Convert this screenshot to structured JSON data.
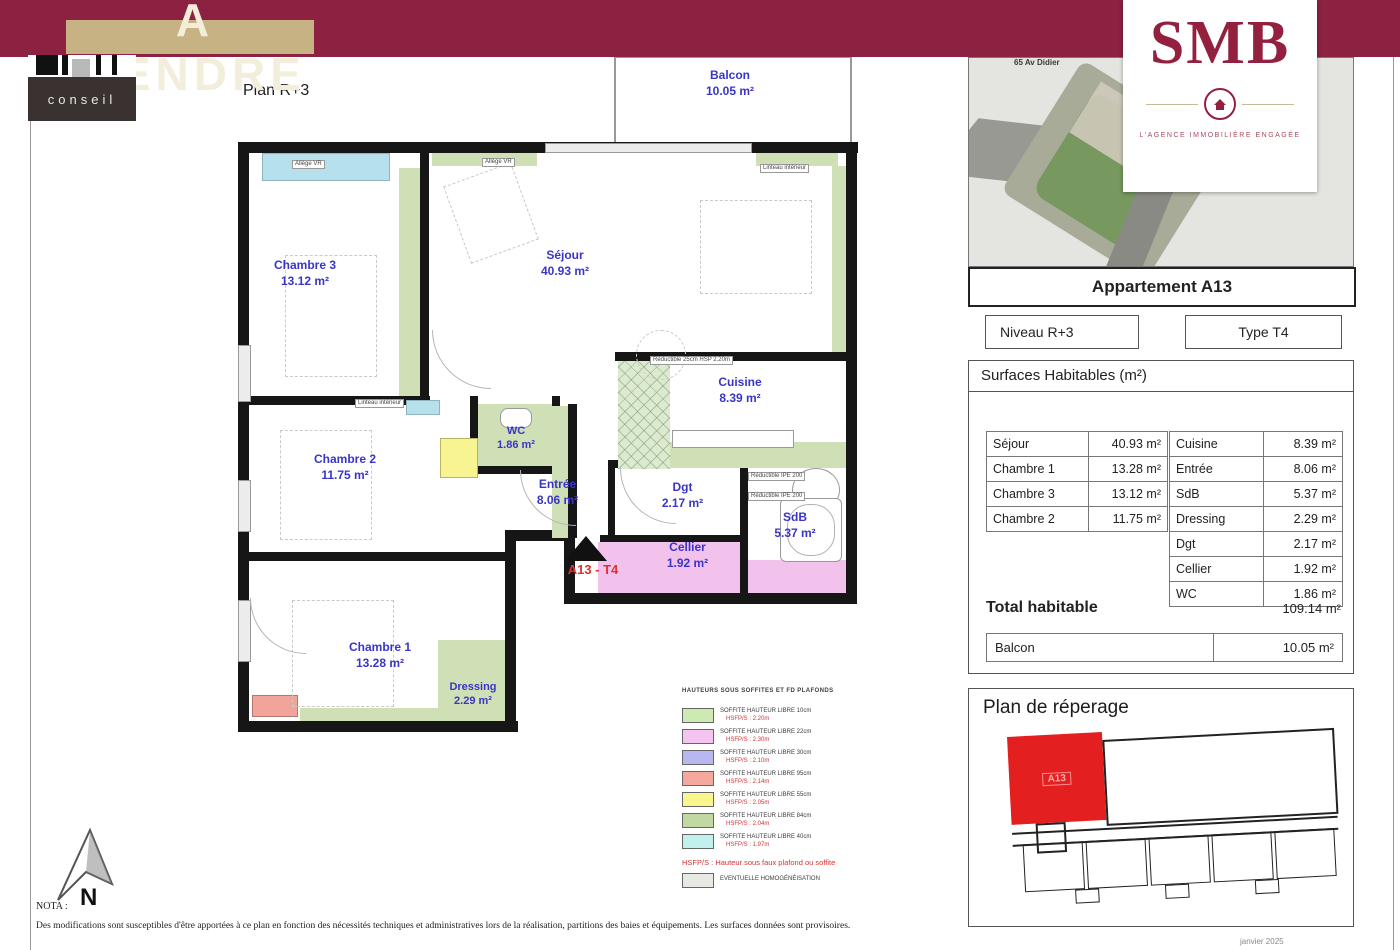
{
  "banner": {
    "title": "A VENDRE"
  },
  "logo": {
    "name": "conseil"
  },
  "plan": {
    "title": "Plan R+3",
    "marker": "A13 - T4",
    "compass": "N",
    "rooms": {
      "balcon": {
        "name": "Balcon",
        "area": "10.05 m²"
      },
      "chambre3": {
        "name": "Chambre 3",
        "area": "13.12 m²"
      },
      "sejour": {
        "name": "Séjour",
        "area": "40.93 m²"
      },
      "cuisine": {
        "name": "Cuisine",
        "area": "8.39 m²"
      },
      "wc": {
        "name": "WC",
        "area": "1.86 m²"
      },
      "chambre2": {
        "name": "Chambre 2",
        "area": "11.75 m²"
      },
      "entree": {
        "name": "Entrée",
        "area": "8.06 m²"
      },
      "dgt": {
        "name": "Dgt",
        "area": "2.17 m²"
      },
      "sdb": {
        "name": "SdB",
        "area": "5.37 m²"
      },
      "cellier": {
        "name": "Cellier",
        "area": "1.92 m²"
      },
      "chambre1": {
        "name": "Chambre 1",
        "area": "13.28 m²"
      },
      "dressing": {
        "name": "Dressing",
        "area": "2.29 m²"
      }
    },
    "annotations": {
      "allege": "Allège VR",
      "linteau": "Linteau intérieur",
      "reductible_hsp": "Réductible 25cm HSP 2.20m",
      "reductible_ipe": "Réductible IPE 200"
    }
  },
  "agency": {
    "name": "SMB",
    "tagline": "L'AGENCE IMMOBILIÈRE ENGAGÉE",
    "address": "65 Av Didier"
  },
  "sidebar": {
    "apartment_title": "Appartement A13",
    "niveau": "Niveau R+3",
    "type": "Type T4",
    "surfaces_title": "Surfaces Habitables (m²)",
    "left_rows": [
      {
        "room": "Séjour",
        "area": "40.93 m²"
      },
      {
        "room": "Chambre 1",
        "area": "13.28 m²"
      },
      {
        "room": "Chambre 3",
        "area": "13.12 m²"
      },
      {
        "room": "Chambre 2",
        "area": "11.75 m²"
      }
    ],
    "right_rows": [
      {
        "room": "Cuisine",
        "area": "8.39 m²"
      },
      {
        "room": "Entrée",
        "area": "8.06 m²"
      },
      {
        "room": "SdB",
        "area": "5.37 m²"
      },
      {
        "room": "Dressing",
        "area": "2.29 m²"
      },
      {
        "room": "Dgt",
        "area": "2.17 m²"
      },
      {
        "room": "Cellier",
        "area": "1.92 m²"
      },
      {
        "room": "WC",
        "area": "1.86 m²"
      }
    ],
    "total_label": "Total habitable",
    "total_value": "109.14 m²",
    "balcon_label": "Balcon",
    "balcon_value": "10.05 m²",
    "reperage_title": "Plan de réperage",
    "reperage_unit": "A13"
  },
  "legend": {
    "title": "HAUTEURS SOUS SOFFITES ET FD PLAFONDS",
    "rows": [
      {
        "color": "#cdeab2",
        "line1": "SOFFITE HAUTEUR LIBRE 10cm",
        "line2": "HSFP/S : 2.20m"
      },
      {
        "color": "#f4c4f0",
        "line1": "SOFFITE HAUTEUR LIBRE 22cm",
        "line2": "HSFP/S : 2.30m"
      },
      {
        "color": "#b8b8f0",
        "line1": "SOFFITE HAUTEUR LIBRE 30cm",
        "line2": "HSFP/S : 2.10m"
      },
      {
        "color": "#f4a89e",
        "line1": "SOFFITE HAUTEUR LIBRE 95cm",
        "line2": "HSFP/S : 2.14m"
      },
      {
        "color": "#faf68e",
        "line1": "SOFFITE HAUTEUR LIBRE 55cm",
        "line2": "HSFP/S : 2.05m"
      },
      {
        "color": "#c2d8a2",
        "line1": "SOFFITE HAUTEUR LIBRE 84cm",
        "line2": "HSFP/S : 2.04m"
      },
      {
        "color": "#c2f0ec",
        "line1": "SOFFITE HAUTEUR LIBRE 40cm",
        "line2": "HSFP/S : 1.97m"
      }
    ],
    "note": "HSFP/S : Hauteur sous faux plafond ou soffite",
    "extra": {
      "color": "#e6eae2",
      "label": "EVENTUELLE HOMOGÉNÉISATION"
    }
  },
  "footer": {
    "nota_title": "NOTA :",
    "nota_text": "Des modifications sont susceptibles d'être apportées à ce plan en fonction des nécessités techniques et administratives lors de la réalisation, partitions des baies et équipements. Les surfaces données sont provisoires.",
    "date": "janvier 2025"
  },
  "colors": {
    "banner": "#8d2142",
    "tan": "#c7b283",
    "plan_green": "#cfe0b6",
    "window_cyan": "#b6e0ec",
    "pink": "#f2c2ec",
    "yellow": "#f8f492",
    "salmon": "#f0a49a",
    "room_label_blue": "#3a35c8",
    "marker_red": "#e03030",
    "reperage_red": "#e41f1f"
  }
}
